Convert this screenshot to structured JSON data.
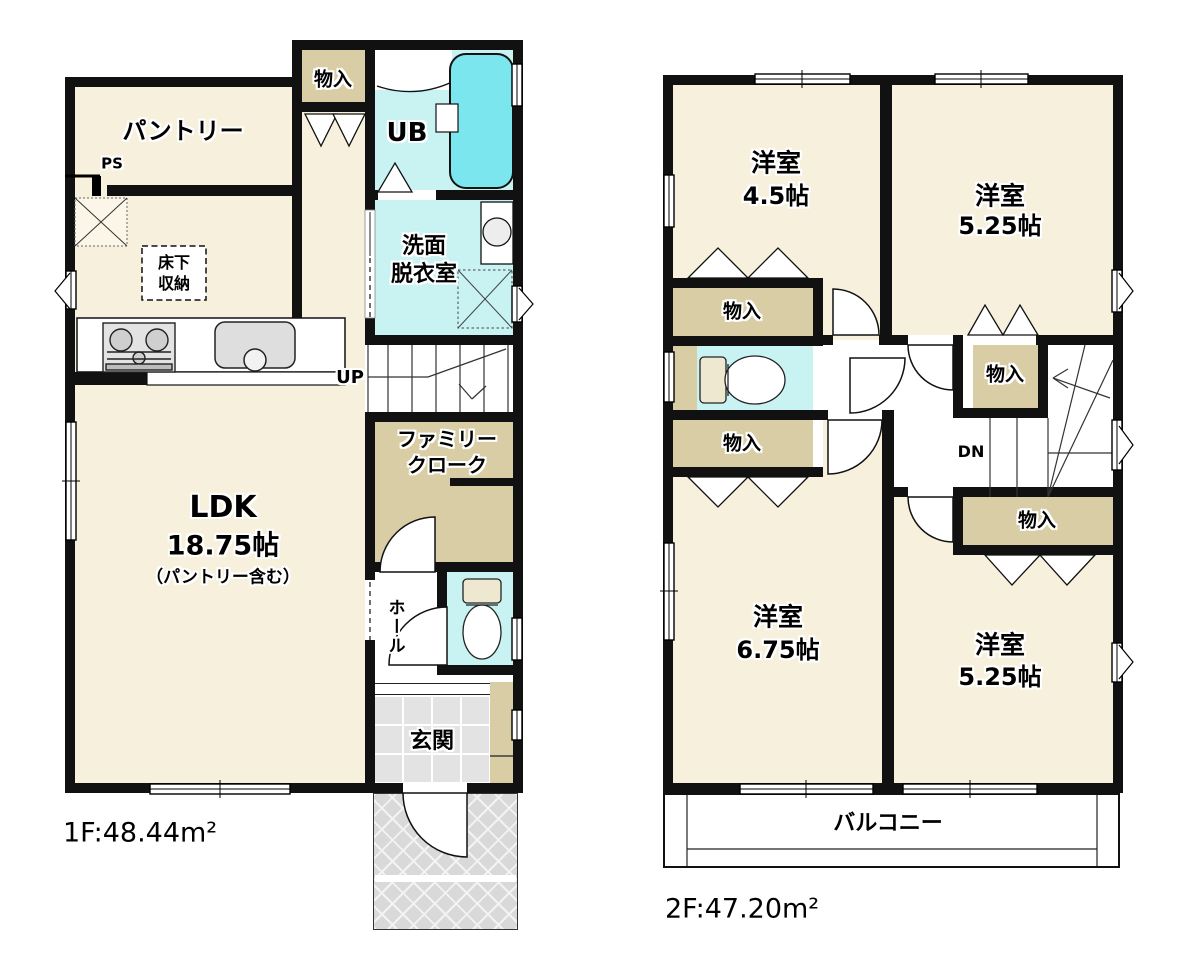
{
  "floor1": {
    "area_label": "1F:48.44m²",
    "labels": {
      "closet": "物入",
      "unit_bath": "UB",
      "pantry": "パントリー",
      "pipe_space": "PS",
      "washroom_l1": "洗面",
      "washroom_l2": "脱衣室",
      "underfloor_l1": "床下",
      "underfloor_l2": "収納",
      "stairs": "UP",
      "family_closet_l1": "ファミリー",
      "family_closet_l2": "クローク",
      "ldk_l1": "LDK",
      "ldk_l2": "18.75帖",
      "ldk_l3": "（パントリー含む）",
      "hall": "ホール",
      "entrance": "玄関"
    }
  },
  "floor2": {
    "area_label": "2F:47.20m²",
    "labels": {
      "room_nw_l1": "洋室",
      "room_nw_l2": "4.5帖",
      "room_ne_l1": "洋室",
      "room_ne_l2": "5.25帖",
      "room_sw_l1": "洋室",
      "room_sw_l2": "6.75帖",
      "room_se_l1": "洋室",
      "room_se_l2": "5.25帖",
      "closet_a": "物入",
      "closet_b": "物入",
      "closet_c": "物入",
      "closet_d": "物入",
      "stairs": "DN",
      "balcony": "バルコニー"
    }
  },
  "colors": {
    "room": "#f7f0dc",
    "closet": "#d8cda5",
    "wet": "#c9f2f3",
    "tub": "#7ce6ee",
    "tile": "#e3e3e3",
    "porch": "#d9d9d9",
    "wall": "#111111"
  }
}
